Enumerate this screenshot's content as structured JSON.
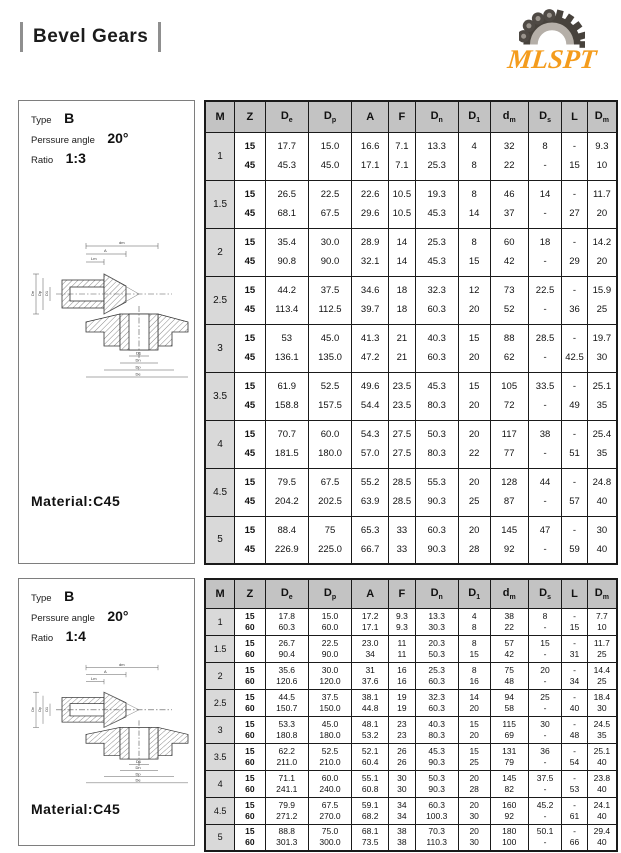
{
  "page": {
    "title": "Bevel Gears",
    "logo_text": "MLSPT",
    "brand_orange": "#F49C1D"
  },
  "columns": [
    {
      "base": "M",
      "sub": ""
    },
    {
      "base": "Z",
      "sub": ""
    },
    {
      "base": "D",
      "sub": "e"
    },
    {
      "base": "D",
      "sub": "p"
    },
    {
      "base": "A",
      "sub": ""
    },
    {
      "base": "F",
      "sub": ""
    },
    {
      "base": "D",
      "sub": "n"
    },
    {
      "base": "D",
      "sub": "1"
    },
    {
      "base": "d",
      "sub": "m"
    },
    {
      "base": "D",
      "sub": "s"
    },
    {
      "base": "L",
      "sub": ""
    },
    {
      "base": "D",
      "sub": "m"
    }
  ],
  "drawing": {
    "dm": "dm",
    "a": "A",
    "lm": "Lm",
    "de": "De",
    "dp": "Dp",
    "dn": "Dn",
    "d1": "D1"
  },
  "sections": [
    {
      "spec": {
        "type_label": "Type",
        "type_value": "B",
        "pressure_label": "Perssure angle",
        "pressure_value": "20°",
        "ratio_label": "Ratio",
        "ratio_value": "1:3"
      },
      "material": "Material:C45",
      "rows": [
        {
          "m": "1",
          "lines": [
            [
              "15",
              "17.7",
              "15.0",
              "16.6",
              "7.1",
              "13.3",
              "4",
              "32",
              "8",
              "-",
              "9.3"
            ],
            [
              "45",
              "45.3",
              "45.0",
              "17.1",
              "7.1",
              "25.3",
              "8",
              "22",
              "-",
              "15",
              "10"
            ]
          ]
        },
        {
          "m": "1.5",
          "lines": [
            [
              "15",
              "26.5",
              "22.5",
              "22.6",
              "10.5",
              "19.3",
              "8",
              "46",
              "14",
              "-",
              "11.7"
            ],
            [
              "45",
              "68.1",
              "67.5",
              "29.6",
              "10.5",
              "45.3",
              "14",
              "37",
              "-",
              "27",
              "20"
            ]
          ]
        },
        {
          "m": "2",
          "lines": [
            [
              "15",
              "35.4",
              "30.0",
              "28.9",
              "14",
              "25.3",
              "8",
              "60",
              "18",
              "-",
              "14.2"
            ],
            [
              "45",
              "90.8",
              "90.0",
              "32.1",
              "14",
              "45.3",
              "15",
              "42",
              "-",
              "29",
              "20"
            ]
          ]
        },
        {
          "m": "2.5",
          "lines": [
            [
              "15",
              "44.2",
              "37.5",
              "34.6",
              "18",
              "32.3",
              "12",
              "73",
              "22.5",
              "-",
              "15.9"
            ],
            [
              "45",
              "113.4",
              "112.5",
              "39.7",
              "18",
              "60.3",
              "20",
              "52",
              "-",
              "36",
              "25"
            ]
          ]
        },
        {
          "m": "3",
          "lines": [
            [
              "15",
              "53",
              "45.0",
              "41.3",
              "21",
              "40.3",
              "15",
              "88",
              "28.5",
              "-",
              "19.7"
            ],
            [
              "45",
              "136.1",
              "135.0",
              "47.2",
              "21",
              "60.3",
              "20",
              "62",
              "-",
              "42.5",
              "30"
            ]
          ]
        },
        {
          "m": "3.5",
          "lines": [
            [
              "15",
              "61.9",
              "52.5",
              "49.6",
              "23.5",
              "45.3",
              "15",
              "105",
              "33.5",
              "-",
              "25.1"
            ],
            [
              "45",
              "158.8",
              "157.5",
              "54.4",
              "23.5",
              "80.3",
              "20",
              "72",
              "-",
              "49",
              "35"
            ]
          ]
        },
        {
          "m": "4",
          "lines": [
            [
              "15",
              "70.7",
              "60.0",
              "54.3",
              "27.5",
              "50.3",
              "20",
              "117",
              "38",
              "-",
              "25.4"
            ],
            [
              "45",
              "181.5",
              "180.0",
              "57.0",
              "27.5",
              "80.3",
              "22",
              "77",
              "-",
              "51",
              "35"
            ]
          ]
        },
        {
          "m": "4.5",
          "lines": [
            [
              "15",
              "79.5",
              "67.5",
              "55.2",
              "28.5",
              "55.3",
              "20",
              "128",
              "44",
              "-",
              "24.8"
            ],
            [
              "45",
              "204.2",
              "202.5",
              "63.9",
              "28.5",
              "90.3",
              "25",
              "87",
              "-",
              "57",
              "40"
            ]
          ]
        },
        {
          "m": "5",
          "lines": [
            [
              "15",
              "88.4",
              "75",
              "65.3",
              "33",
              "60.3",
              "20",
              "145",
              "47",
              "-",
              "30"
            ],
            [
              "45",
              "226.9",
              "225.0",
              "66.7",
              "33",
              "90.3",
              "28",
              "92",
              "-",
              "59",
              "40"
            ]
          ]
        }
      ]
    },
    {
      "spec": {
        "type_label": "Type",
        "type_value": "B",
        "pressure_label": "Perssure angle",
        "pressure_value": "20°",
        "ratio_label": "Ratio",
        "ratio_value": "1:4"
      },
      "material": "Material:C45",
      "rows": [
        {
          "m": "1",
          "lines": [
            [
              "15",
              "17.8",
              "15.0",
              "17.2",
              "9.3",
              "13.3",
              "4",
              "38",
              "8",
              "-",
              "7.7"
            ],
            [
              "60",
              "60.3",
              "60.0",
              "17.1",
              "9.3",
              "30.3",
              "8",
              "22",
              "-",
              "15",
              "10"
            ]
          ]
        },
        {
          "m": "1.5",
          "lines": [
            [
              "15",
              "26.7",
              "22.5",
              "23.0",
              "11",
              "20.3",
              "8",
              "57",
              "15",
              "-",
              "11.7"
            ],
            [
              "60",
              "90.4",
              "90.0",
              "34",
              "11",
              "50.3",
              "15",
              "42",
              "-",
              "31",
              "25"
            ]
          ]
        },
        {
          "m": "2",
          "lines": [
            [
              "15",
              "35.6",
              "30.0",
              "31",
              "16",
              "25.3",
              "8",
              "75",
              "20",
              "-",
              "14.4"
            ],
            [
              "60",
              "120.6",
              "120.0",
              "37.6",
              "16",
              "60.3",
              "16",
              "48",
              "-",
              "34",
              "25"
            ]
          ]
        },
        {
          "m": "2.5",
          "lines": [
            [
              "15",
              "44.5",
              "37.5",
              "38.1",
              "19",
              "32.3",
              "14",
              "94",
              "25",
              "-",
              "18.4"
            ],
            [
              "60",
              "150.7",
              "150.0",
              "44.8",
              "19",
              "60.3",
              "20",
              "58",
              "-",
              "40",
              "30"
            ]
          ]
        },
        {
          "m": "3",
          "lines": [
            [
              "15",
              "53.3",
              "45.0",
              "48.1",
              "23",
              "40.3",
              "15",
              "115",
              "30",
              "-",
              "24.5"
            ],
            [
              "60",
              "180.8",
              "180.0",
              "53.2",
              "23",
              "80.3",
              "20",
              "69",
              "-",
              "48",
              "35"
            ]
          ]
        },
        {
          "m": "3.5",
          "lines": [
            [
              "15",
              "62.2",
              "52.5",
              "52.1",
              "26",
              "45.3",
              "15",
              "131",
              "36",
              "-",
              "25.1"
            ],
            [
              "60",
              "211.0",
              "210.0",
              "60.4",
              "26",
              "90.3",
              "25",
              "79",
              "-",
              "54",
              "40"
            ]
          ]
        },
        {
          "m": "4",
          "lines": [
            [
              "15",
              "71.1",
              "60.0",
              "55.1",
              "30",
              "50.3",
              "20",
              "145",
              "37.5",
              "-",
              "23.8"
            ],
            [
              "60",
              "241.1",
              "240.0",
              "60.8",
              "30",
              "90.3",
              "28",
              "82",
              "-",
              "53",
              "40"
            ]
          ]
        },
        {
          "m": "4.5",
          "lines": [
            [
              "15",
              "79.9",
              "67.5",
              "59.1",
              "34",
              "60.3",
              "20",
              "160",
              "45.2",
              "-",
              "24.1"
            ],
            [
              "60",
              "271.2",
              "270.0",
              "68.2",
              "34",
              "100.3",
              "30",
              "92",
              "-",
              "61",
              "40"
            ]
          ]
        },
        {
          "m": "5",
          "lines": [
            [
              "15",
              "88.8",
              "75.0",
              "68.1",
              "38",
              "70.3",
              "20",
              "180",
              "50.1",
              "-",
              "29.4"
            ],
            [
              "60",
              "301.3",
              "300.0",
              "73.5",
              "38",
              "110.3",
              "30",
              "100",
              "-",
              "66",
              "40"
            ]
          ]
        }
      ]
    }
  ]
}
